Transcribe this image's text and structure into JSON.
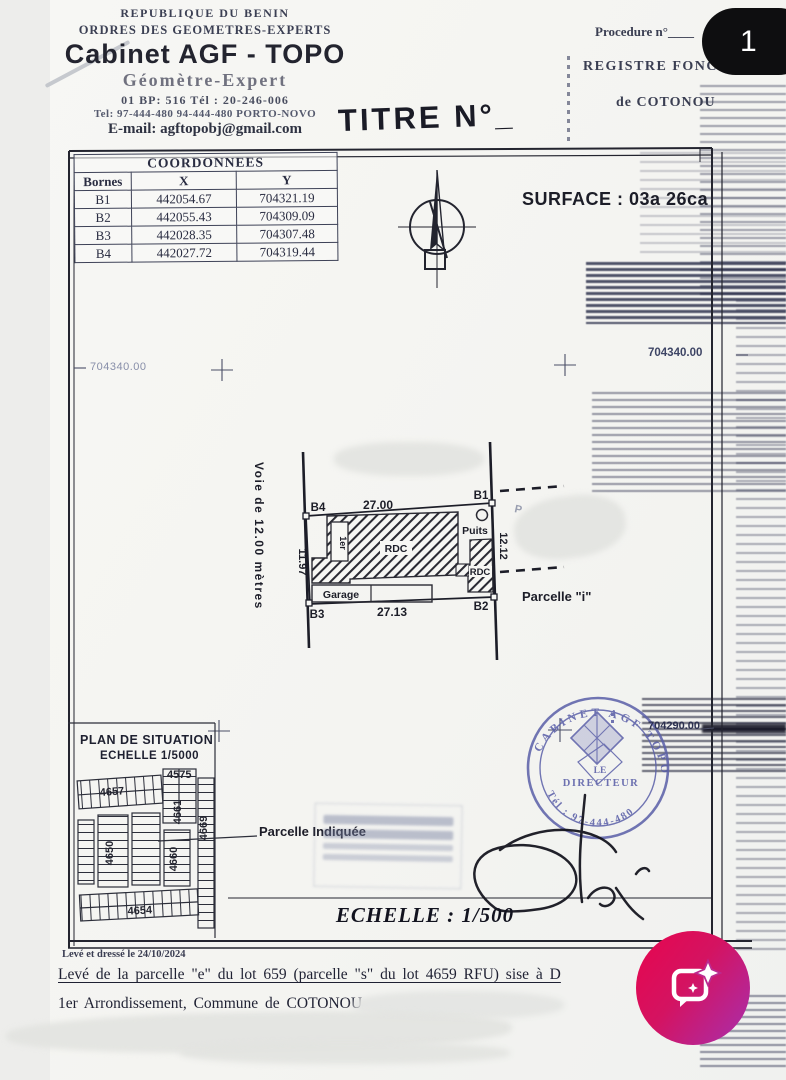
{
  "viewer": {
    "page_badge": "1"
  },
  "letterhead": {
    "country": "REPUBLIQUE DU BENIN",
    "order": "ORDRES DES GEOMETRES-EXPERTS",
    "name": "Cabinet AGF - TOPO",
    "subtitle": "Géomètre-Expert",
    "bp_line": "01 BP: 516 Tél : 20-246-006",
    "tel_line": "Tel: 97-444-480 94-444-480 PORTO-NOVO",
    "email": "E-mail: agftopobj@gmail.com"
  },
  "title": "TITRE N°_",
  "topright": {
    "procedure": "Procedure n°____",
    "registre": "REGISTRE FONCIER",
    "ville": "de COTONOU"
  },
  "surface": "SURFACE : 03a 26ca",
  "coordtable": {
    "title": "COORDONNEES",
    "columns": [
      "Bornes",
      "X",
      "Y"
    ],
    "rows": [
      [
        "B1",
        "442054.67",
        "704321.19"
      ],
      [
        "B2",
        "442055.43",
        "704309.09"
      ],
      [
        "B3",
        "442028.35",
        "704307.48"
      ],
      [
        "B4",
        "442027.72",
        "704319.44"
      ]
    ]
  },
  "gridlabels": {
    "left": "704340.00",
    "right": "704340.00",
    "stamp_row": "704290.00"
  },
  "plan": {
    "road": "Voie de 12.00 mètres",
    "dim_top": "27.00",
    "dim_bottom": "27.13",
    "dim_left": "11.97",
    "dim_right": "12.12",
    "b1": "B1",
    "b2": "B2",
    "b3": "B3",
    "b4": "B4",
    "rdc_main": "RDC",
    "rdc_small": "RDC",
    "floor": "1er",
    "garage": "Garage",
    "puits": "Puits",
    "parcelle_adjacent": "Parcelle \"i\"",
    "remnant_letter": "P"
  },
  "situation": {
    "title": "PLAN DE SITUATION",
    "scale": "ECHELLE 1/5000",
    "lots": {
      "a": "4657",
      "b": "4575",
      "c": "4661",
      "d": "4669",
      "e": "4650",
      "f": "4660",
      "g": "4654"
    },
    "indicated": "Parcelle Indiquée"
  },
  "stamp": {
    "arc_top": "CABINET AGF TOPO",
    "center_line1": "LE",
    "center_line2": "DIRECTEUR",
    "arc_bottom": "Tél : 97-444-480"
  },
  "scale_label": "ECHELLE : 1/500",
  "footer": {
    "date": "Levé et dressé le 24/10/2024",
    "line1": "Levé de la parcelle \"e\" du lot 659 (parcelle \"s\" du lot 4659 RFU) sise à D",
    "line2": "1er Arrondissement, Commune de COTONOU"
  }
}
